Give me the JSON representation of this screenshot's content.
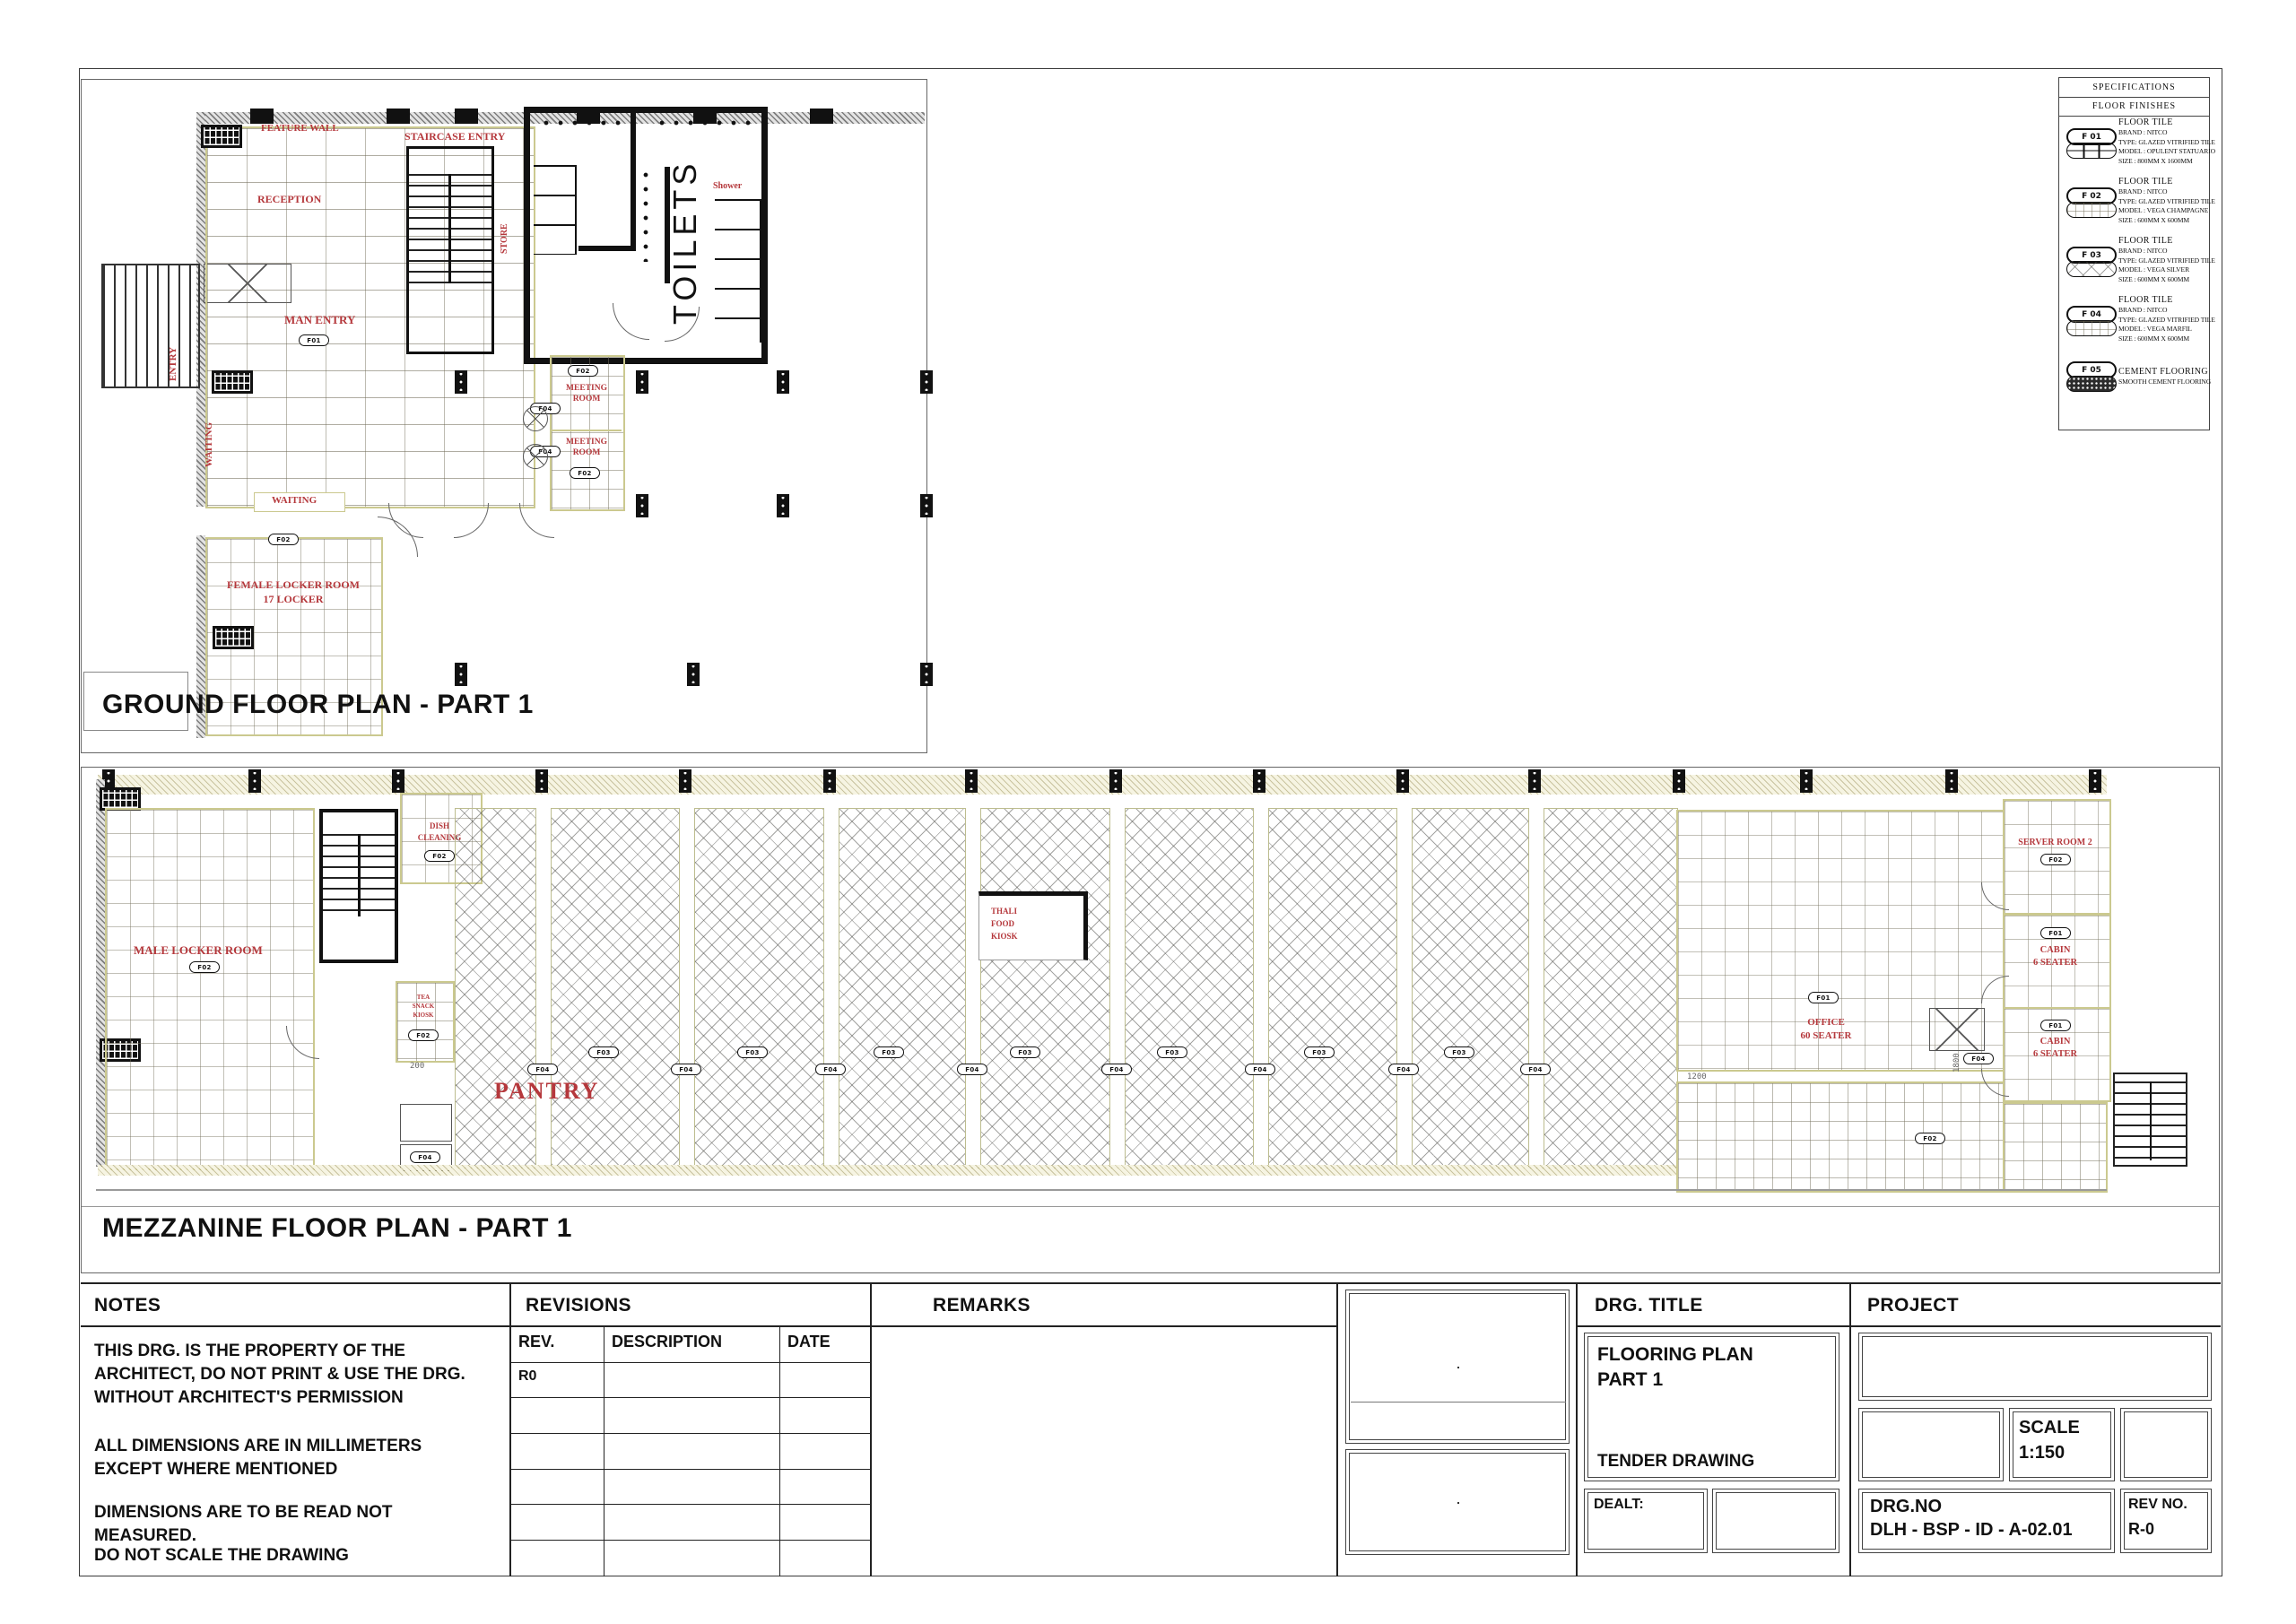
{
  "specifications": {
    "title": "SPECIFICATIONS",
    "subtitle": "FLOOR  FINISHES",
    "items": [
      {
        "code": "F 01",
        "pattern": "grid-large",
        "lines": [
          "FLOOR TILE",
          "BRAND : NITCO",
          "TYPE: GLAZED VITRIFIED TILE",
          "MODEL : OPULENT STATUARIO",
          "SIZE : 800MM X 1600MM"
        ]
      },
      {
        "code": "F 02",
        "pattern": "grid-fine",
        "lines": [
          "FLOOR TILE",
          "BRAND : NITCO",
          "TYPE: GLAZED VITRIFIED TILE",
          "MODEL : VEGA CHAMPAGNE",
          "SIZE : 600MM X 600MM"
        ]
      },
      {
        "code": "F 03",
        "pattern": "crosshatch",
        "lines": [
          "FLOOR TILE",
          "BRAND : NITCO",
          "TYPE: GLAZED VITRIFIED TILE",
          "MODEL : VEGA SILVER",
          "SIZE : 600MM X 600MM"
        ]
      },
      {
        "code": "F 04",
        "pattern": "grid-fine",
        "lines": [
          "FLOOR TILE",
          "BRAND : NITCO",
          "TYPE: GLAZED VITRIFIED TILE",
          "MODEL : VEGA MARFIL",
          "SIZE : 600MM X 600MM"
        ]
      },
      {
        "code": "F 05",
        "pattern": "speckle",
        "lines": [
          "CEMENT FLOORING",
          "SMOOTH CEMENT FLOORING"
        ]
      }
    ]
  },
  "tags": {
    "f01": "F01",
    "f02": "F02",
    "f03": "F03",
    "f04": "F04"
  },
  "ground": {
    "title": "GROUND FLOOR PLAN - PART 1",
    "labels": {
      "feature_wall": "FEATURE WALL",
      "reception": "RECEPTION",
      "staircase_entry": "STAIRCASE ENTRY",
      "store": "STORE",
      "toilets": "TOILETS",
      "shower": "Shower",
      "man_entry": "MAN ENTRY",
      "waiting": "WAITING",
      "meeting_room": "MEETING ROOM",
      "female_locker_1": "FEMALE LOCKER ROOM",
      "female_locker_2": "17 LOCKER",
      "entry": "ENTRY"
    }
  },
  "mezzanine": {
    "title": "MEZZANINE FLOOR PLAN - PART 1",
    "labels": {
      "male_locker": "MALE LOCKER ROOM",
      "dish_1": "DISH",
      "dish_2": "CLEANING",
      "tea_1": "TEA",
      "tea_2": "SNACK",
      "tea_3": "KIOSK",
      "pantry": "PANTRY",
      "thali_1": "THALI",
      "thali_2": "FOOD",
      "thali_3": "KIOSK",
      "server_room": "SERVER ROOM 2",
      "cabin": "CABIN",
      "cabin_seats": "6 SEATER",
      "office_1": "OFFICE",
      "office_2": "60 SEATER"
    },
    "dims": {
      "d200": "200",
      "d1200": "1200",
      "d1800": "1800"
    }
  },
  "title_block": {
    "notes": {
      "header": "NOTES",
      "p1": "THIS DRG. IS THE PROPERTY OF THE ARCHITECT, DO NOT PRINT & USE THE DRG. WITHOUT ARCHITECT'S PERMISSION",
      "p2": "ALL DIMENSIONS ARE IN MILLIMETERS EXCEPT WHERE MENTIONED",
      "p3": "DIMENSIONS ARE TO BE READ NOT MEASURED.",
      "p4": "DO NOT SCALE THE DRAWING"
    },
    "revisions": {
      "header": "REVISIONS",
      "columns": [
        "REV.",
        "DESCRIPTION",
        "DATE"
      ],
      "rows": [
        [
          "R0",
          "",
          ""
        ],
        [
          "",
          "",
          ""
        ],
        [
          "",
          "",
          ""
        ],
        [
          "",
          "",
          ""
        ],
        [
          "",
          "",
          ""
        ],
        [
          "",
          "",
          ""
        ]
      ]
    },
    "remarks": {
      "header": "REMARKS"
    },
    "drg_title": {
      "header": "DRG.  TITLE",
      "line1": "FLOORING PLAN",
      "line2": "PART 1",
      "subtitle": "TENDER DRAWING",
      "dealt_label": "DEALT:"
    },
    "project": {
      "header": "PROJECT",
      "scale_label": "SCALE",
      "scale_value": "1:150",
      "drg_no_label": "DRG.NO",
      "drg_no_value": "DLH - BSP - ID - A-02.01",
      "rev_no_label": "REV NO.",
      "rev_no_value": "R-0"
    }
  }
}
